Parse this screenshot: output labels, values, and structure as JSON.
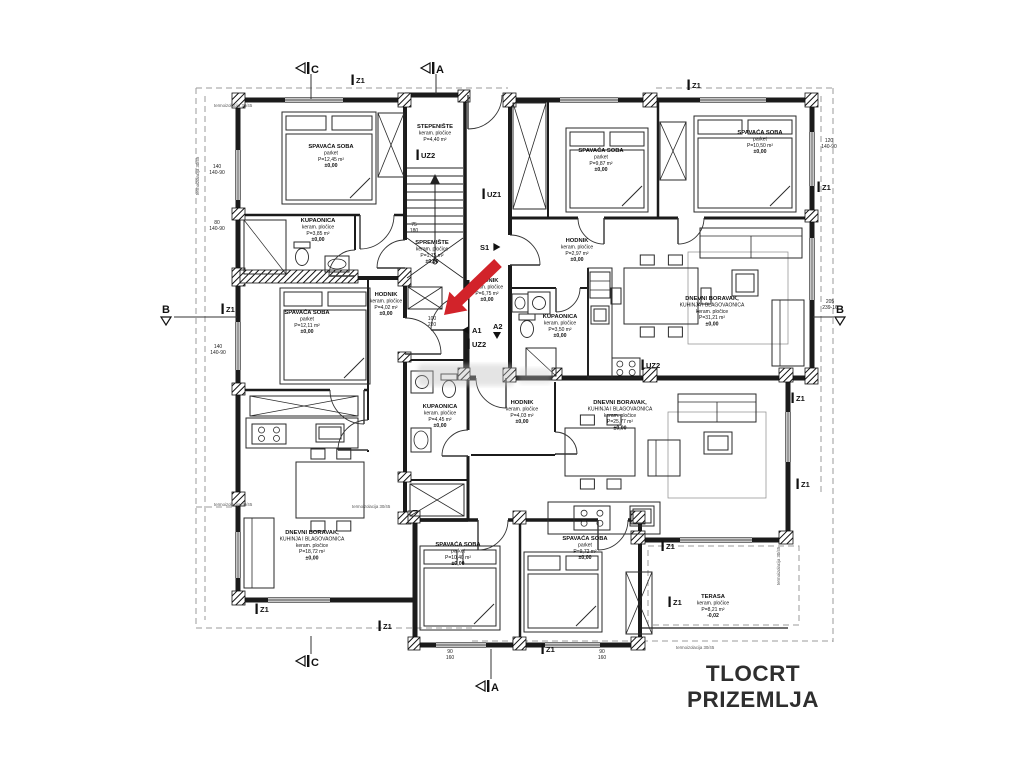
{
  "title": "TLOCRT PRIZEMLJA",
  "colors": {
    "arrow": "#d2232a",
    "walls": "#1b1b1b",
    "dashed": "#9b9b9b",
    "text": "#111111"
  },
  "rooms": [
    {
      "x": 331,
      "y": 148,
      "lines": [
        "SPAVAĆA SOBA",
        "parket",
        "P=12,45 m²",
        "±0,00"
      ]
    },
    {
      "x": 318,
      "y": 222,
      "lines": [
        "KUPAONICA",
        "keram. pločice",
        "P=3,85 m²",
        "±0,00"
      ]
    },
    {
      "x": 435,
      "y": 128,
      "lines": [
        "STEPENIŠTE",
        "keram. pločice",
        "P=4,40 m²"
      ]
    },
    {
      "x": 432,
      "y": 244,
      "lines": [
        "SPREMIŠTE",
        "keram. pločice",
        "P=1,75 m²",
        "±0,00"
      ]
    },
    {
      "x": 386,
      "y": 296,
      "lines": [
        "HODNIK",
        "keram. pločice",
        "P=4,02 m²",
        "±0,00"
      ]
    },
    {
      "x": 307,
      "y": 314,
      "lines": [
        "SPAVAĆA SOBA",
        "parket",
        "P=12,11 m²",
        "±0,00"
      ]
    },
    {
      "x": 487,
      "y": 282,
      "lines": [
        "HODNIK",
        "keram. pločice",
        "P=6,75 m²",
        "±0,00"
      ]
    },
    {
      "x": 560,
      "y": 318,
      "lines": [
        "KUPAONICA",
        "keram. pločice",
        "P=3,50 m²",
        "±0,00"
      ]
    },
    {
      "x": 577,
      "y": 242,
      "lines": [
        "HODNIK",
        "keram. pločice",
        "P=2,97 m²",
        "±0,00"
      ]
    },
    {
      "x": 601,
      "y": 152,
      "lines": [
        "SPAVAĆA SOBA",
        "parket",
        "P=9,87 m²",
        "±0,00"
      ]
    },
    {
      "x": 760,
      "y": 134,
      "lines": [
        "SPAVAĆA SOBA",
        "parket",
        "P=10,50 m²",
        "±0,00"
      ]
    },
    {
      "x": 712,
      "y": 300,
      "lines": [
        "DNEVNI BORAVAK,",
        "KUHINJA I BLAGOVAONICA",
        "keram. pločice",
        "P=31,21 m²",
        "±0,00"
      ]
    },
    {
      "x": 440,
      "y": 408,
      "lines": [
        "KUPAONICA",
        "keram. pločice",
        "P=4,45 m²",
        "±0,00"
      ]
    },
    {
      "x": 522,
      "y": 404,
      "lines": [
        "HODNIK",
        "keram. pločice",
        "P=4,03 m²",
        "±0,00"
      ]
    },
    {
      "x": 620,
      "y": 404,
      "lines": [
        "DNEVNI BORAVAK,",
        "KUHINJA I BLAGOVAONICA",
        "keram. pločice",
        "P=25,77 m²",
        "±0,00"
      ]
    },
    {
      "x": 312,
      "y": 534,
      "lines": [
        "DNEVNI BORAVAK,",
        "KUHINJA I BLAGOVAONICA",
        "keram. pločice",
        "P=18,72 m²",
        "±0,00"
      ]
    },
    {
      "x": 458,
      "y": 546,
      "lines": [
        "SPAVAĆA SOBA",
        "parket",
        "P=10,40 m²",
        "±0,00"
      ]
    },
    {
      "x": 585,
      "y": 540,
      "lines": [
        "SPAVAĆA SOBA",
        "parket",
        "P=9,72 m²",
        "±0,00"
      ]
    },
    {
      "x": 713,
      "y": 598,
      "lines": [
        "TERASA",
        "keram. pločice",
        "P=8,21 m²",
        "-0,02"
      ]
    }
  ],
  "axis_markers": [
    {
      "label": "Z1",
      "x": 358,
      "y": 83
    },
    {
      "label": "Z1",
      "x": 694,
      "y": 88
    },
    {
      "label": "Z1",
      "x": 824,
      "y": 190
    },
    {
      "label": "Z1",
      "x": 228,
      "y": 312
    },
    {
      "label": "Z1",
      "x": 798,
      "y": 401
    },
    {
      "label": "Z1",
      "x": 803,
      "y": 487
    },
    {
      "label": "Z1",
      "x": 262,
      "y": 612
    },
    {
      "label": "Z1",
      "x": 385,
      "y": 629
    },
    {
      "label": "Z1",
      "x": 548,
      "y": 652
    },
    {
      "label": "Z1",
      "x": 668,
      "y": 549
    },
    {
      "label": "Z1",
      "x": 675,
      "y": 605
    }
  ],
  "wall_markers": [
    {
      "label": "UZ2",
      "x": 423,
      "y": 158
    },
    {
      "label": "UZ1",
      "x": 489,
      "y": 197
    },
    {
      "label": "UZ2",
      "x": 474,
      "y": 347
    },
    {
      "label": "UZ2",
      "x": 648,
      "y": 368
    }
  ],
  "direction_markers": [
    {
      "label": "S1",
      "x": 480,
      "y": 250,
      "tri": "right"
    },
    {
      "label": "A1",
      "x": 472,
      "y": 333,
      "tri": "left"
    },
    {
      "label": "A2",
      "x": 493,
      "y": 329,
      "tri": "down"
    }
  ],
  "section_markers": [
    {
      "label": "C",
      "x": 296,
      "y": 63,
      "orient": "left",
      "line": [
        311,
        74,
        311,
        99
      ]
    },
    {
      "label": "A",
      "x": 421,
      "y": 63,
      "orient": "left",
      "line": [
        436,
        74,
        436,
        94
      ]
    },
    {
      "label": "C",
      "x": 296,
      "y": 656,
      "orient": "left",
      "line": [
        311,
        636,
        311,
        654
      ]
    },
    {
      "label": "A",
      "x": 476,
      "y": 681,
      "orient": "left",
      "line": [
        491,
        649,
        491,
        679
      ]
    },
    {
      "label": "B",
      "x": 162,
      "y": 313,
      "orient": "down",
      "line": [
        174,
        317,
        237,
        317
      ]
    },
    {
      "label": "B",
      "x": 836,
      "y": 313,
      "orient": "down",
      "line": [
        813,
        317,
        834,
        317
      ]
    }
  ],
  "dimensions": [
    {
      "x": 217,
      "y": 168,
      "lines": [
        "140",
        "140-90"
      ]
    },
    {
      "x": 217,
      "y": 224,
      "lines": [
        "80",
        "140-90"
      ]
    },
    {
      "x": 218,
      "y": 348,
      "lines": [
        "140",
        "140-90"
      ]
    },
    {
      "x": 829,
      "y": 142,
      "lines": [
        "120",
        "140-90"
      ]
    },
    {
      "x": 830,
      "y": 303,
      "lines": [
        "205",
        "239-16"
      ]
    },
    {
      "x": 414,
      "y": 226,
      "lines": [
        "75",
        "180"
      ]
    },
    {
      "x": 432,
      "y": 320,
      "lines": [
        "100",
        "220"
      ]
    },
    {
      "x": 450,
      "y": 653,
      "lines": [
        "90",
        "160"
      ]
    },
    {
      "x": 602,
      "y": 653,
      "lines": [
        "90",
        "160"
      ]
    }
  ],
  "construction_notes": [
    {
      "x": 214,
      "y": 107,
      "rot": 0,
      "text": "termoizolacija 30/45"
    },
    {
      "x": 199,
      "y": 195,
      "rot": -90,
      "text": "termoizolacija 30/45"
    },
    {
      "x": 214,
      "y": 506,
      "rot": 0,
      "text": "termoizolacija 30/45"
    },
    {
      "x": 352,
      "y": 508,
      "rot": 0,
      "text": "termoizolacija 30/45"
    },
    {
      "x": 780,
      "y": 585,
      "rot": -90,
      "text": "termoizolacija 30/45"
    },
    {
      "x": 676,
      "y": 649,
      "rot": 0,
      "text": "termoizolacija 30/45"
    }
  ]
}
